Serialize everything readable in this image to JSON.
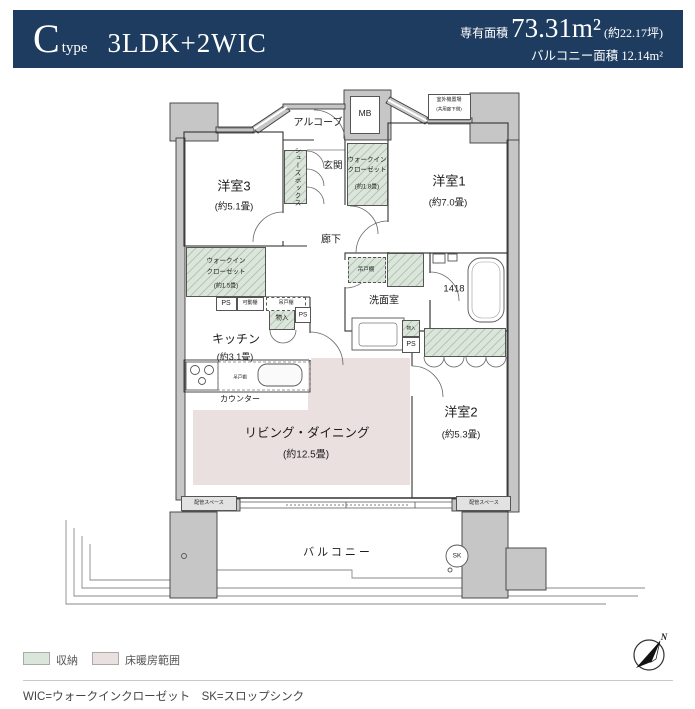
{
  "header": {
    "type_letter": "C",
    "type_word": "type",
    "layout": "3LDK+2WIC",
    "area_label": "専有面積",
    "area_value": "73.31m²",
    "area_tsubo": "(約22.17坪)",
    "balcony_label": "バルコニー面積",
    "balcony_value": "12.14m²"
  },
  "plan": {
    "bedroom3": {
      "name": "洋室3",
      "size": "(約5.1畳)"
    },
    "bedroom1": {
      "name": "洋室1",
      "size": "(約7.0畳)"
    },
    "bedroom2": {
      "name": "洋室2",
      "size": "(約5.3畳)"
    },
    "living": {
      "name": "リビング・ダイニング",
      "size": "(約12.5畳)"
    },
    "kitchen": {
      "name": "キッチン",
      "size": "(約3.1畳)"
    },
    "washroom": "洗面室",
    "entrance": "玄関",
    "hallway": "廊下",
    "alcove": "アルコーブ",
    "balcony": "バルコニー",
    "meter_box": "MB",
    "shoe_box": "シューズボックス",
    "wic_entrance": {
      "line1": "ウォークイン",
      "line2": "クローゼット",
      "size": "(約1.8畳)"
    },
    "wic_kitchen": {
      "line1": "ウォークイン",
      "line2": "クローゼット",
      "size": "(約1.5畳)"
    },
    "outdoor_unit": {
      "line1": "室外機置場",
      "line2": "(共用廊下側)"
    },
    "pipe_space": "PS",
    "movable_shelf": "可動棚",
    "hanging_cupboard": "吊戸棚",
    "storage_small": "物入",
    "bath_size": "1418",
    "pipe_area": "配管スペース",
    "counter": "カウンター",
    "slop_sink": "SK",
    "north": "N"
  },
  "legend": {
    "storage": "収納",
    "floor_heating": "床暖房範囲"
  },
  "footer": {
    "note": "WIC=ウォークインクローゼット　SK=スロップシンク"
  },
  "colors": {
    "header_navy": "#1d3c5f",
    "storage_green": "#dbe6db",
    "floor_heating_pink": "#ebe0e0",
    "wall_gray": "#c6c6c6"
  }
}
